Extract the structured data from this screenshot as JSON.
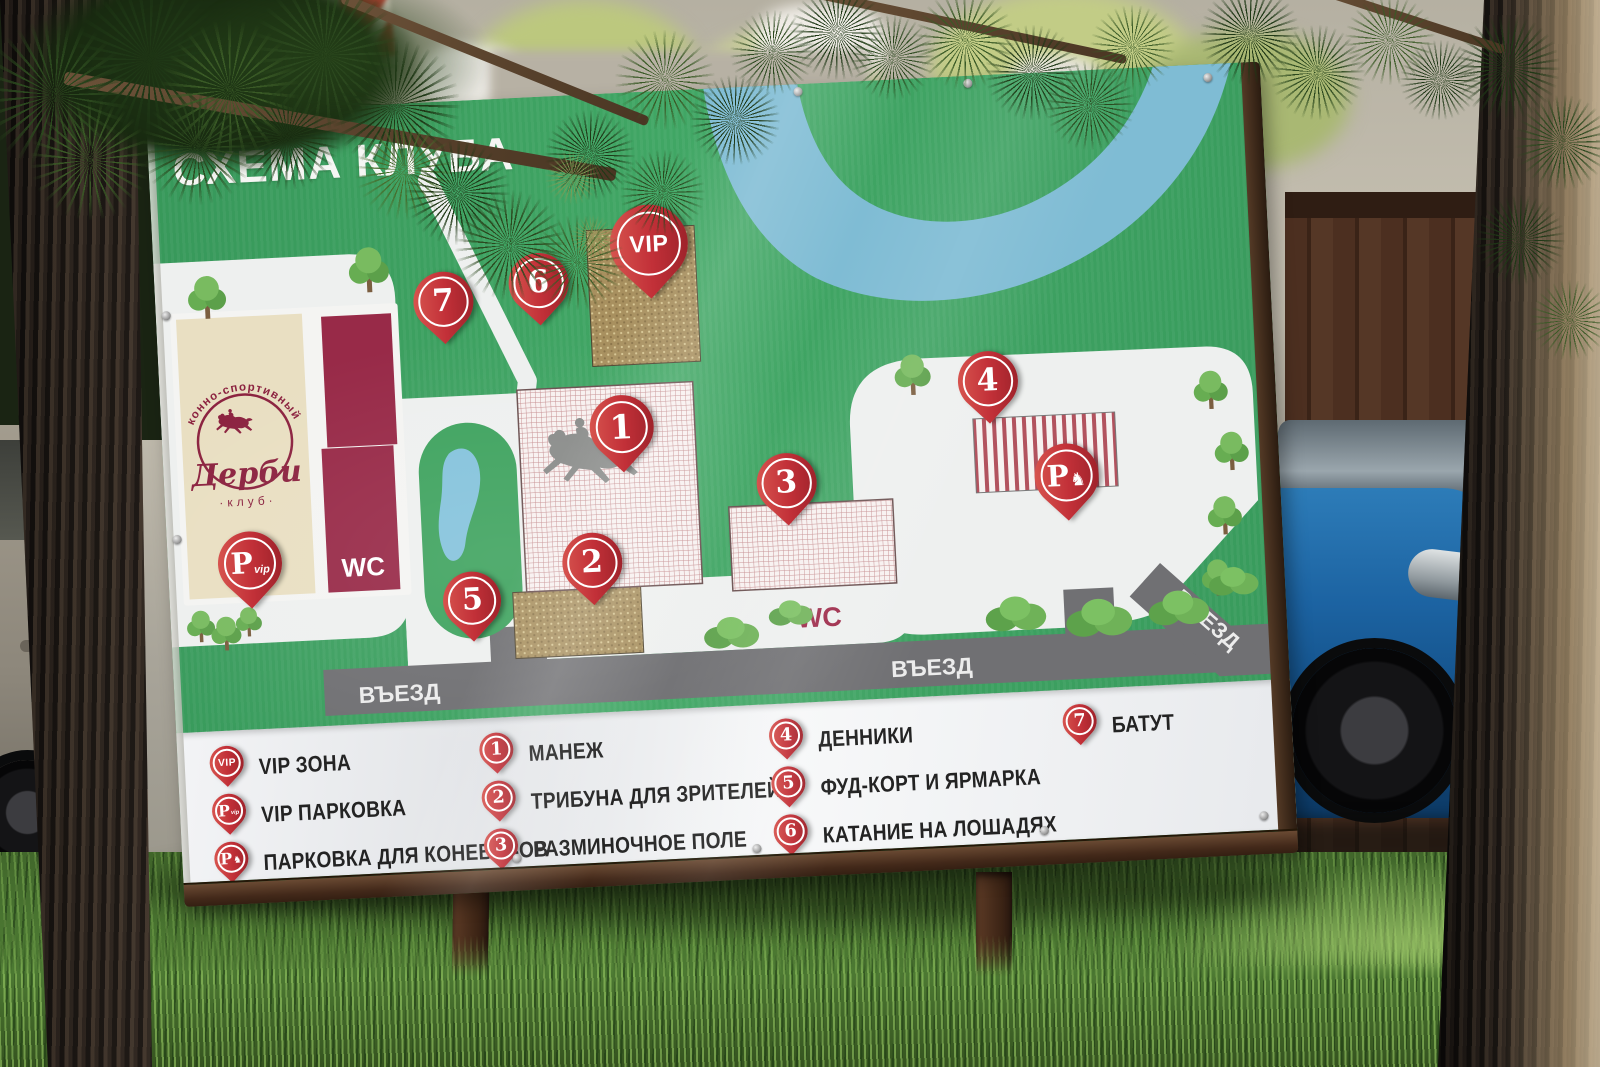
{
  "sign": {
    "title": "СХЕМА КЛУБА",
    "logo": {
      "arc": "конно-спортивный",
      "name": "Дерби",
      "sub": "·клуб·"
    },
    "map": {
      "wc_building": "WC",
      "wc_ground": "WC",
      "entrance_left": "ВЪЕЗД",
      "entrance_right": "ВЪЕЗД",
      "entrance_diag": "ВЪЕЗД",
      "pins": {
        "vip": "VIP",
        "p_main": "P",
        "p_vip_sub": "vip",
        "n1": "1",
        "n2": "2",
        "n3": "3",
        "n4": "4",
        "n5": "5",
        "n6": "6",
        "n7": "7"
      }
    },
    "legend": {
      "items": [
        {
          "icon": "vip-pin",
          "pin_text": "VIP",
          "label": "VIP ЗОНА"
        },
        {
          "icon": "p-vip-pin",
          "pin_main": "P",
          "pin_sub": "vip",
          "label": "VIP ПАРКОВКА"
        },
        {
          "icon": "p-horse-pin",
          "pin_main": "P",
          "label": "ПАРКОВКА ДЛЯ КОНЕВОЗОВ"
        },
        {
          "icon": "pin-1",
          "num": "1",
          "label": "МАНЕЖ"
        },
        {
          "icon": "pin-2",
          "num": "2",
          "label": "ТРИБУНА ДЛЯ ЗРИТЕЛЕЙ"
        },
        {
          "icon": "pin-3",
          "num": "3",
          "label": "РАЗМИНОЧНОЕ ПОЛЕ"
        },
        {
          "icon": "pin-4",
          "num": "4",
          "label": "ДЕННИКИ"
        },
        {
          "icon": "pin-5",
          "num": "5",
          "label": "ФУД-КОРТ И ЯРМАРКА"
        },
        {
          "icon": "pin-6",
          "num": "6",
          "label": "КАТАНИЕ НА ЛОШАДЯХ"
        },
        {
          "icon": "pin-7",
          "num": "7",
          "label": "БАТУТ"
        }
      ]
    },
    "icons": {
      "horse_glyph": "♞"
    },
    "colors": {
      "sign_green": "#3da060",
      "river_blue": "#7fbcd4",
      "pin_red": "#c23038",
      "building_maroon": "#982a48",
      "logo_cream": "#e9dfc2",
      "zone_tan": "#a8905f",
      "road_grey": "#707073",
      "legend_bg": "#eef0f2",
      "grass_green": "#4d7a33"
    }
  }
}
